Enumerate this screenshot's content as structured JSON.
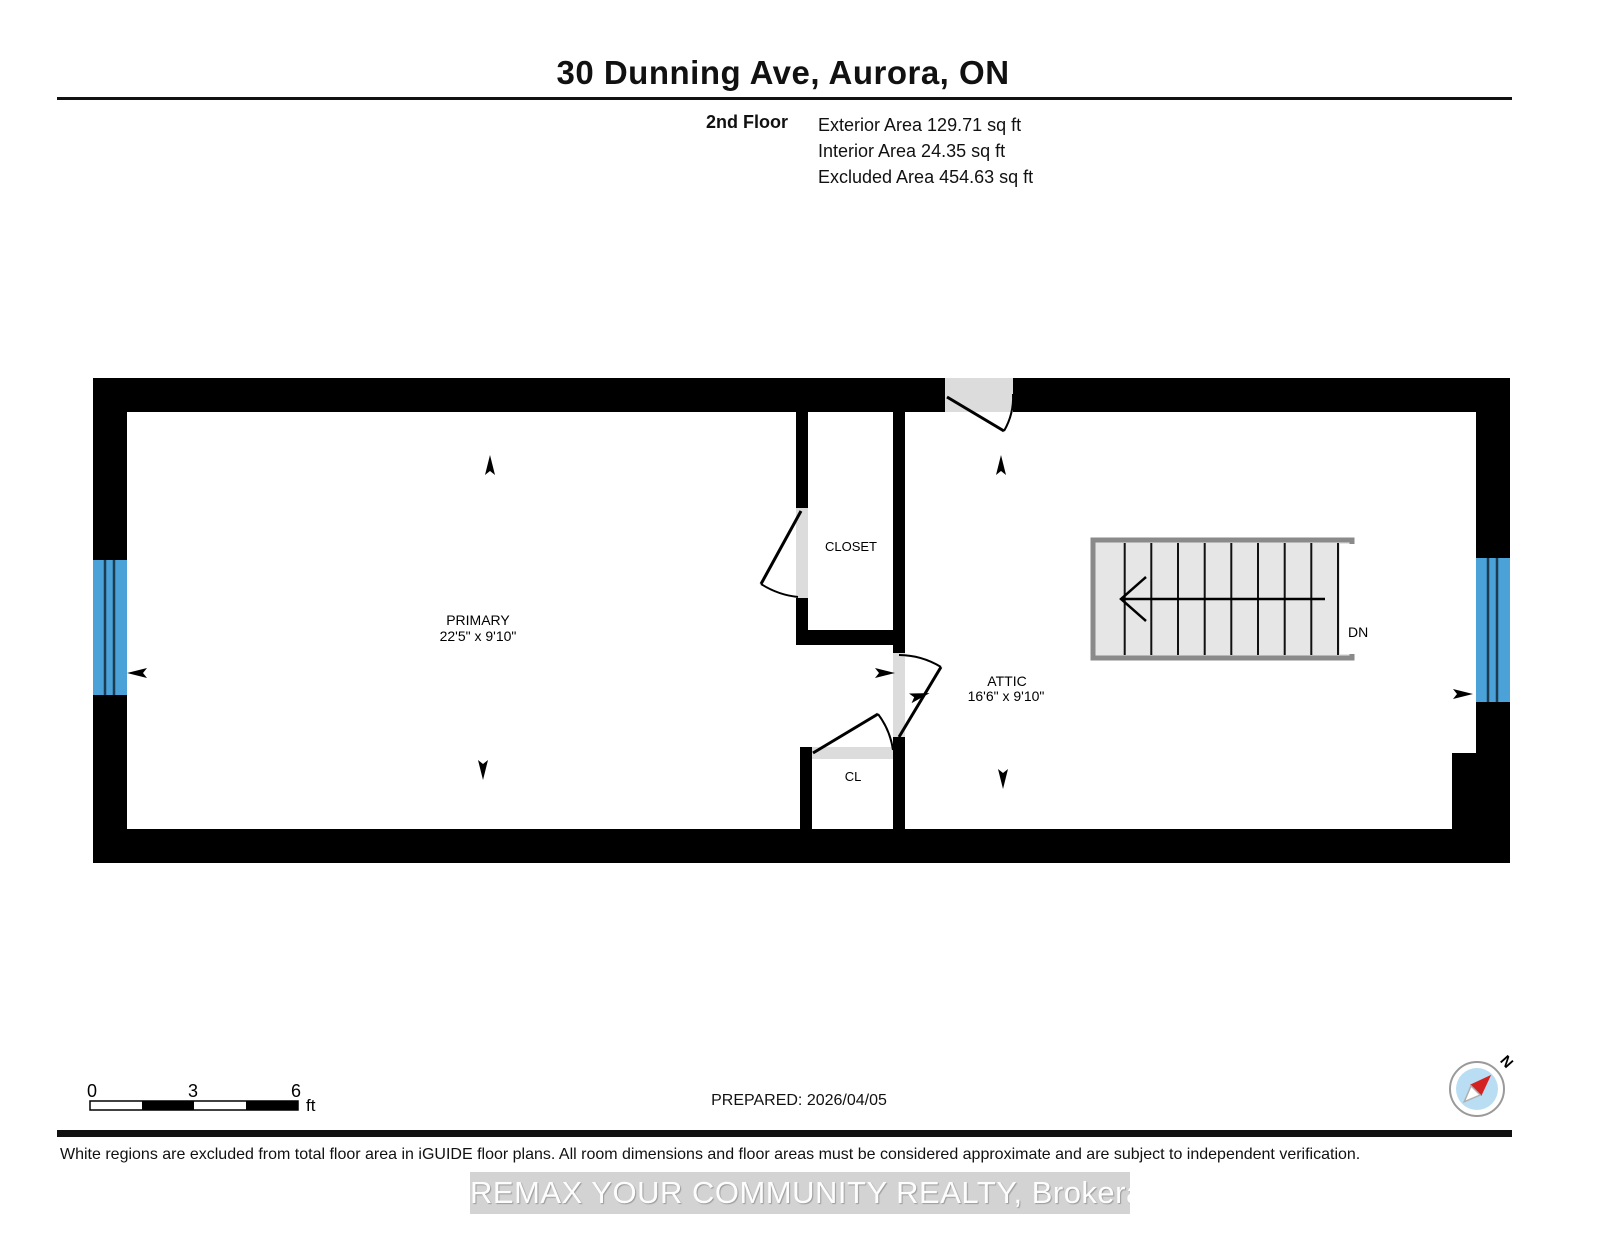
{
  "header": {
    "title": "30 Dunning Ave, Aurora, ON",
    "floor_label": "2nd Floor",
    "area_lines": [
      "Exterior Area 129.71 sq ft",
      "Interior Area 24.35 sq ft",
      "Excluded Area 454.63 sq ft"
    ]
  },
  "rooms": [
    {
      "name": "PRIMARY",
      "dims": "22'5\" x 9'10\""
    },
    {
      "name": "ATTIC",
      "dims": "16'6\" x 9'10\""
    },
    {
      "name": "CLOSET"
    },
    {
      "name": "CL"
    }
  ],
  "stairs": {
    "label": "DN"
  },
  "scale_bar": {
    "ticks": [
      "0",
      "3",
      "6"
    ],
    "unit": "ft"
  },
  "prepared": "PREPARED: 2026/04/05",
  "compass": {
    "label": "N"
  },
  "footer": {
    "disclaimer": "White regions are excluded from total floor area in iGUIDE floor plans. All room dimensions and floor areas must be considered approximate and are subject to independent verification.",
    "watermark": "REMAX YOUR COMMUNITY REALTY, Brokerage"
  },
  "colors": {
    "wall": "#000000",
    "window": "#4aa2d9",
    "window_divider": "#1d3c52",
    "door_fill": "#dcdcdc",
    "stair_fill": "#e6e6e6",
    "stair_border": "#8a8a8a",
    "compass_blue": "#b9ddf3",
    "compass_needle": "#d42222"
  }
}
